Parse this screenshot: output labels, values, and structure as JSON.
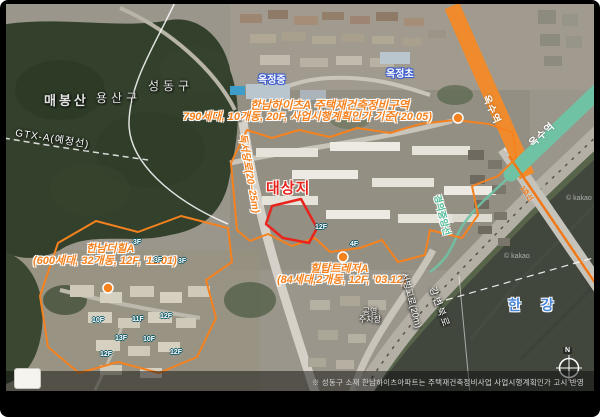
{
  "map": {
    "regions": {
      "mountain": "매봉산",
      "yongsan": "용산구",
      "seongdong": "성동구",
      "river": "한 강"
    },
    "schools": {
      "okjeong_middle": "옥정중",
      "okjeong_elem": "옥정초"
    },
    "sites": {
      "target": "대상지",
      "heights_title": "한남하이츠A 주택재건축정비구역",
      "heights_detail": "790세대, 10개동, 20F, 사업시행계획인가 기준('20.05)",
      "thehill_title": "한남더힐A",
      "thehill_detail": "(600세대, 32개동, 12F, '11.01)",
      "hilltop_title": "힐탑트레저A",
      "hilltop_detail": "(84세대,2개동, 12F, '03.12)"
    },
    "roads": {
      "dokseodang": "독서당로(20~25m)",
      "seobinggo": "서빙고로(20m)",
      "gangbyeon": "강변북로",
      "gtx": "GTX-A(예정선)"
    },
    "transit": {
      "line3_station": "옥수역",
      "jungang_station": "옥수역",
      "line3": "3호선",
      "jungang_line": "경의중앙선"
    },
    "poi": {
      "parking_top": "공영",
      "parking_bottom": "주차장"
    },
    "floor_badges": [
      "3F",
      "3F",
      "3F",
      "12F",
      "4F",
      "10F",
      "11F",
      "12F",
      "13F",
      "10F",
      "12F",
      "12F"
    ],
    "compass": "N",
    "watermark": "© kakao",
    "footnote": "※ 성동구 소재 한남하이츠아파트는 주택재건축정비사업 사업시행계획인가 고시 반영",
    "colors": {
      "zone_orange": "#f5821f",
      "site_red": "#e8251d",
      "line3_orange": "#ef8b2c",
      "jungang_teal": "#6fc2a4",
      "school_blue": "#3b5bd0",
      "river_label_blue": "#4a86d8"
    }
  }
}
